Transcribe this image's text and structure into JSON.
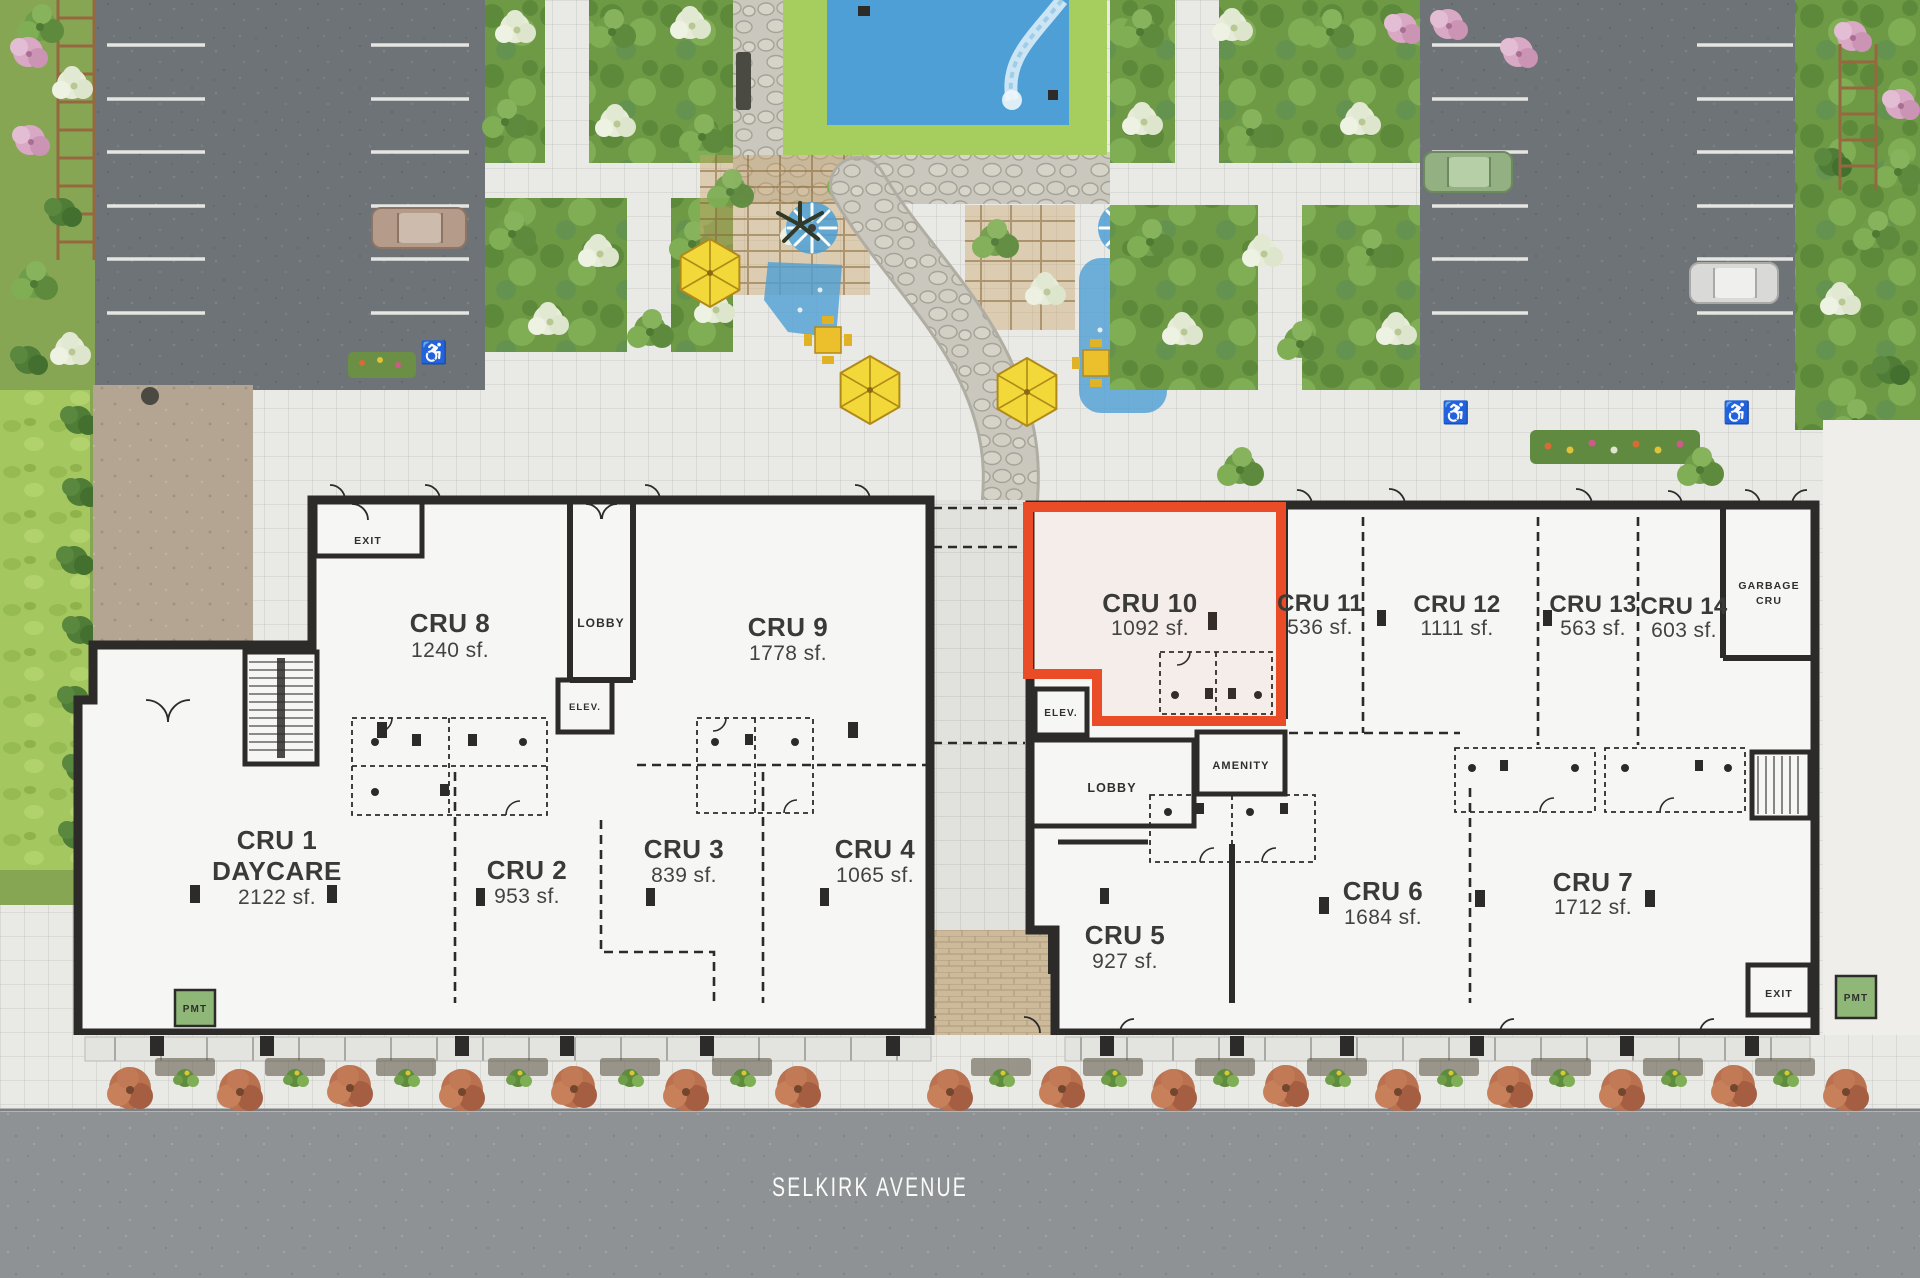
{
  "street": {
    "label": "SELKIRK AVENUE"
  },
  "units": [
    {
      "name": "CRU 1",
      "use": "DAYCARE",
      "area": "2122 sf."
    },
    {
      "name": "CRU 2",
      "area": "953 sf."
    },
    {
      "name": "CRU 3",
      "area": "839 sf."
    },
    {
      "name": "CRU 4",
      "area": "1065 sf."
    },
    {
      "name": "CRU 5",
      "area": "927 sf."
    },
    {
      "name": "CRU 6",
      "area": "1684 sf."
    },
    {
      "name": "CRU 7",
      "area": "1712 sf."
    },
    {
      "name": "CRU 8",
      "area": "1240 sf."
    },
    {
      "name": "CRU 9",
      "area": "1778 sf."
    },
    {
      "name": "CRU 10",
      "area": "1092 sf.",
      "highlighted": true
    },
    {
      "name": "CRU 11",
      "area": "536 sf."
    },
    {
      "name": "CRU 12",
      "area": "1111 sf."
    },
    {
      "name": "CRU 13",
      "area": "563 sf."
    },
    {
      "name": "CRU 14",
      "area": "603 sf."
    }
  ],
  "rooms": {
    "exit": "EXIT",
    "lobby": "LOBBY",
    "elevator": "ELEV.",
    "amenity": "AMENITY",
    "garbage_line1": "GARBAGE",
    "garbage_line2": "CRU",
    "pmt": "PMT"
  },
  "markings": {
    "accessible_icon": "♿"
  },
  "colors": {
    "highlight": "#E94C26",
    "pool_water": "#4E9FD6",
    "pool_deck": "#A6CE5E",
    "umbrella_yellow": "#F2D838",
    "street_tree": "#B9714F"
  }
}
